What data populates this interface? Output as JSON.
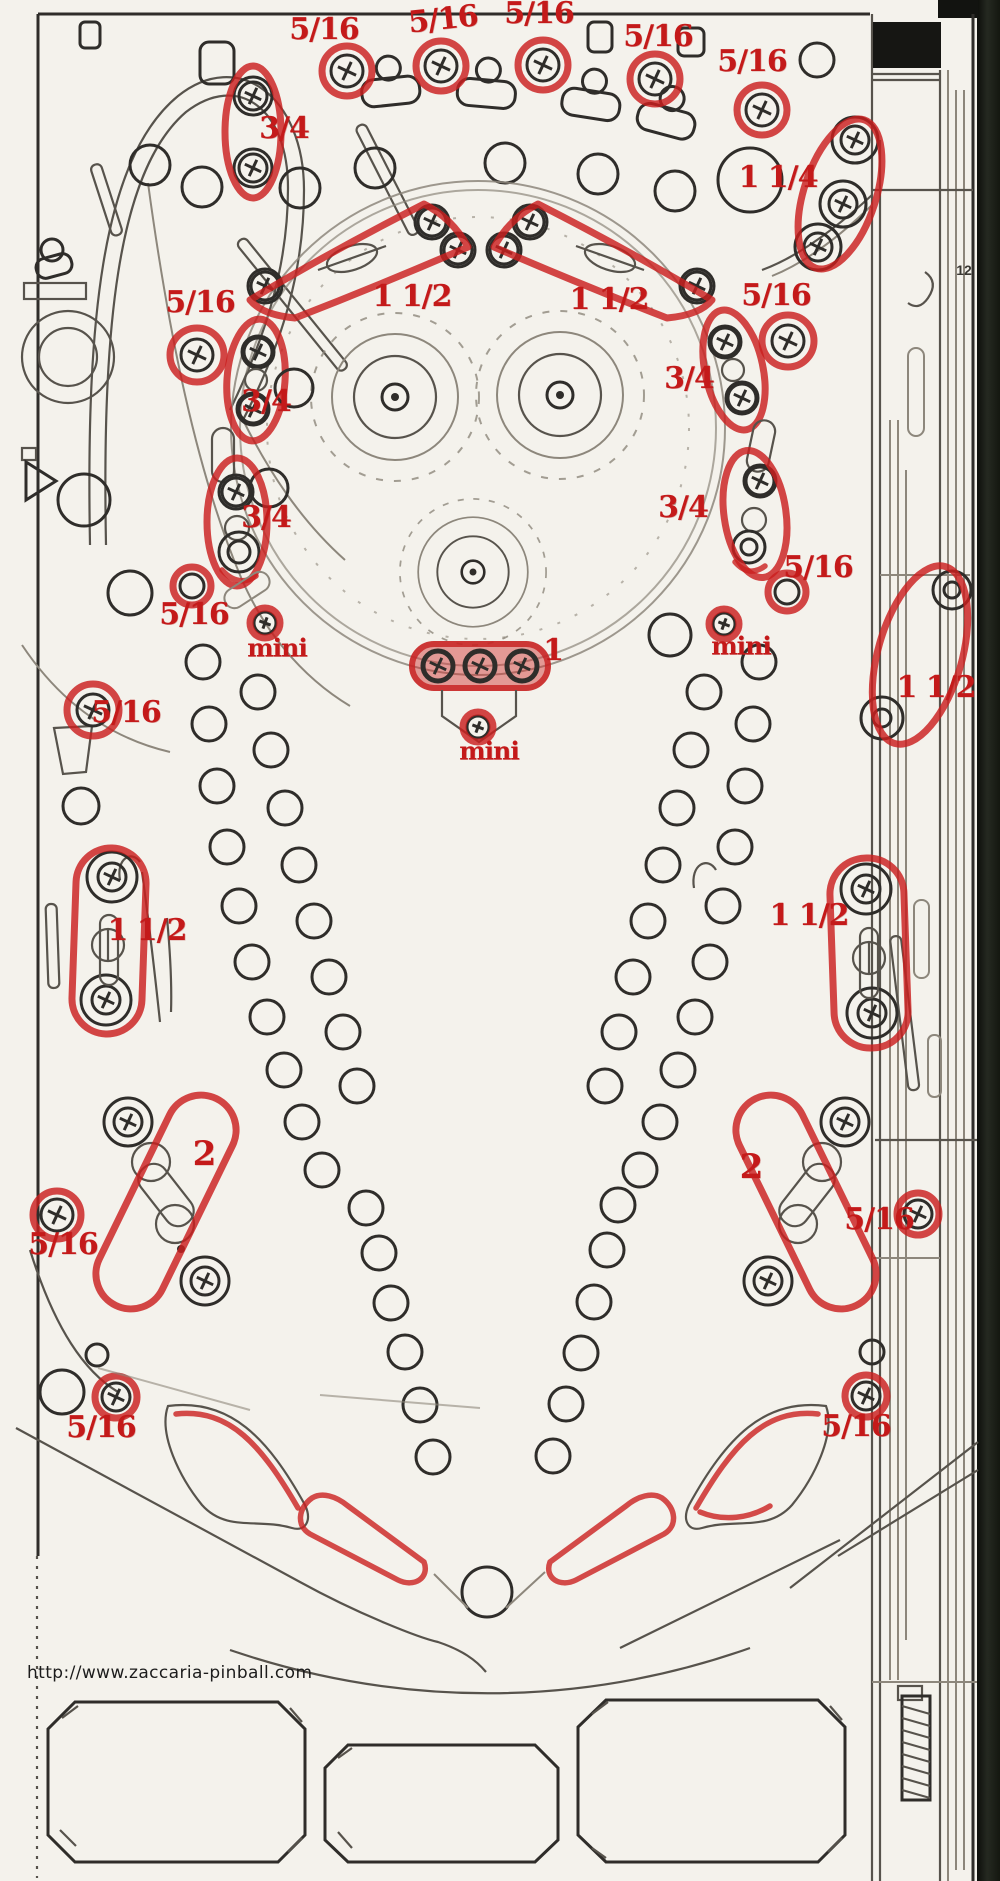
{
  "watermark": {
    "url_text": "http://www.zaccaria-pinball.com",
    "x": 27,
    "y": 1663
  },
  "colors": {
    "annotation_red": "#c41a1a",
    "ink": "#3a3833",
    "paper": "#f4f2ec",
    "side_strip_dark": "#191b15"
  },
  "annotations": [
    {
      "label": "5/16",
      "x": 324,
      "y": 30,
      "size": 30,
      "rot": 0
    },
    {
      "label": "5/16",
      "x": 443,
      "y": 20,
      "size": 30,
      "rot": -6
    },
    {
      "label": "5/16",
      "x": 539,
      "y": 14,
      "size": 30,
      "rot": 0
    },
    {
      "label": "5/16",
      "x": 658,
      "y": 37,
      "size": 30,
      "rot": 0
    },
    {
      "label": "5/16",
      "x": 752,
      "y": 62,
      "size": 30,
      "rot": 0
    },
    {
      "label": "3/4",
      "x": 284,
      "y": 129,
      "size": 30,
      "rot": 0
    },
    {
      "label": "1 1/4",
      "x": 778,
      "y": 178,
      "size": 30,
      "rot": 0
    },
    {
      "label": "5/16",
      "x": 200,
      "y": 303,
      "size": 30,
      "rot": 0
    },
    {
      "label": "1 1/2",
      "x": 412,
      "y": 297,
      "size": 30,
      "rot": 0
    },
    {
      "label": "1 1/2",
      "x": 609,
      "y": 300,
      "size": 30,
      "rot": 0
    },
    {
      "label": "5/16",
      "x": 776,
      "y": 296,
      "size": 30,
      "rot": 0
    },
    {
      "label": "3/4",
      "x": 266,
      "y": 402,
      "size": 30,
      "rot": 0
    },
    {
      "label": "3/4",
      "x": 689,
      "y": 379,
      "size": 30,
      "rot": 0
    },
    {
      "label": "3/4",
      "x": 266,
      "y": 518,
      "size": 30,
      "rot": 0
    },
    {
      "label": "3/4",
      "x": 683,
      "y": 508,
      "size": 30,
      "rot": 0
    },
    {
      "label": "5/16",
      "x": 818,
      "y": 568,
      "size": 30,
      "rot": 0
    },
    {
      "label": "5/16",
      "x": 194,
      "y": 615,
      "size": 30,
      "rot": 0
    },
    {
      "label": "mini",
      "x": 277,
      "y": 648,
      "size": 25,
      "rot": 0
    },
    {
      "label": "1",
      "x": 553,
      "y": 651,
      "size": 30,
      "rot": 0
    },
    {
      "label": "mini",
      "x": 741,
      "y": 646,
      "size": 25,
      "rot": 0
    },
    {
      "label": "mini",
      "x": 489,
      "y": 751,
      "size": 25,
      "rot": 0
    },
    {
      "label": "1 1/2",
      "x": 936,
      "y": 688,
      "size": 30,
      "rot": 0
    },
    {
      "label": "5/16",
      "x": 126,
      "y": 713,
      "size": 30,
      "rot": 0
    },
    {
      "label": "1 1/2",
      "x": 147,
      "y": 931,
      "size": 30,
      "rot": 0
    },
    {
      "label": "1 1/2",
      "x": 809,
      "y": 916,
      "size": 30,
      "rot": 0
    },
    {
      "label": "2",
      "x": 204,
      "y": 1154,
      "size": 34,
      "rot": 0
    },
    {
      "label": "2",
      "x": 751,
      "y": 1167,
      "size": 34,
      "rot": 0
    },
    {
      "label": "5/16",
      "x": 63,
      "y": 1245,
      "size": 30,
      "rot": 0
    },
    {
      "label": "5/16",
      "x": 879,
      "y": 1220,
      "size": 30,
      "rot": 0
    },
    {
      "label": "5/16",
      "x": 101,
      "y": 1428,
      "size": 30,
      "rot": 0
    },
    {
      "label": "5/16",
      "x": 856,
      "y": 1427,
      "size": 30,
      "rot": 0
    },
    {
      "label": "12",
      "x": 964,
      "y": 270,
      "size": 14,
      "rot": 0,
      "color": "ink"
    }
  ]
}
